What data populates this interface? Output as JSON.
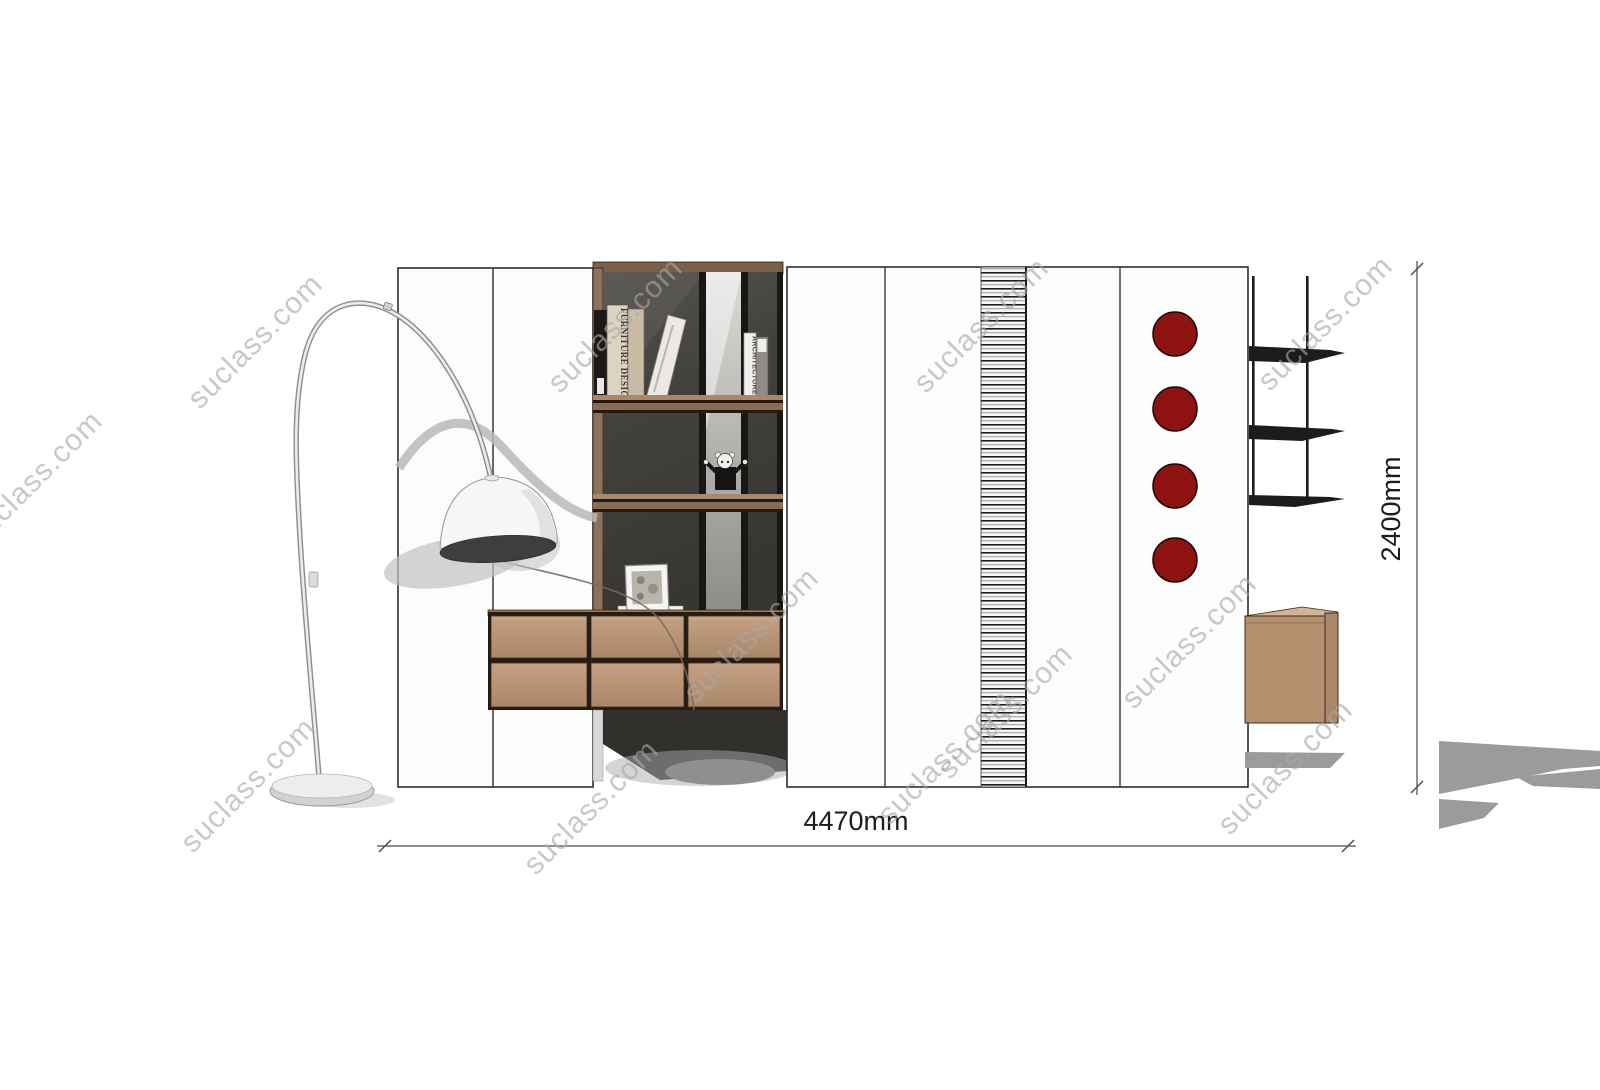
{
  "drawing": {
    "width_dimension": "4470mm",
    "height_dimension": "2400mm"
  },
  "bookshelf": {
    "book_spine_1": "FURNITURE DESIGN",
    "book_spine_2": "ARCHITECTURE"
  },
  "watermark": {
    "text": "suclass.com"
  },
  "decor": {
    "dot_color": "#8e1310",
    "dot_count": 4,
    "wood_color": "#b5906f",
    "dark_panel_color": "#3f3d3a",
    "shadow_color": "#9b9b9b"
  }
}
